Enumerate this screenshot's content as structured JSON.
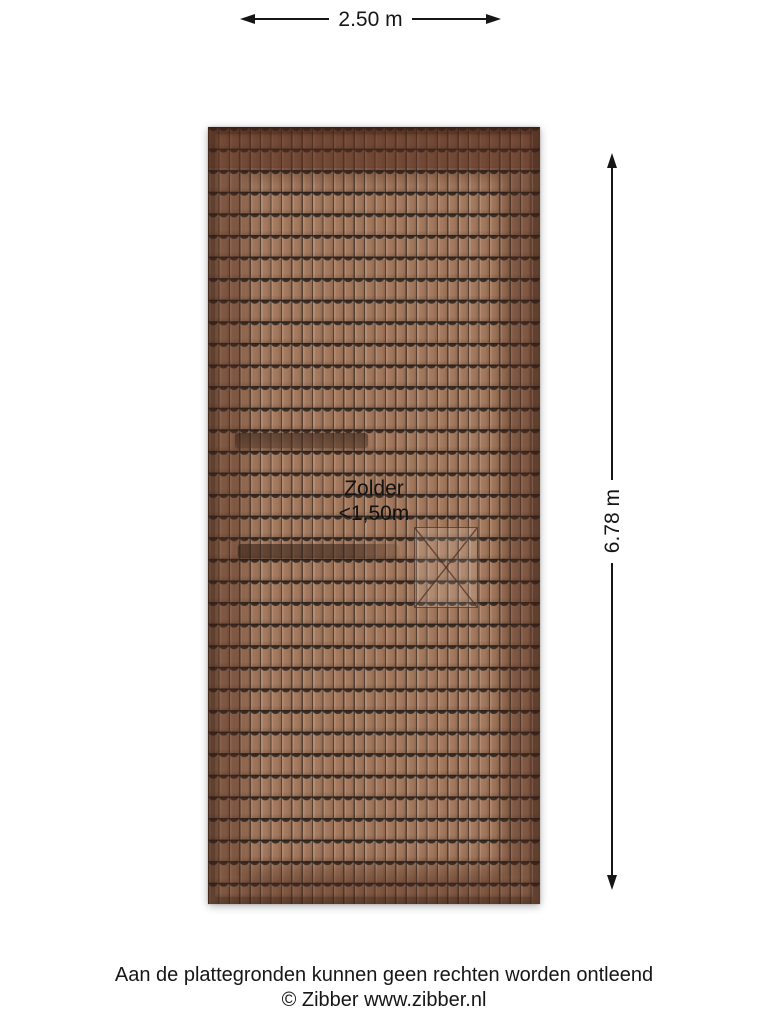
{
  "plan": {
    "room_label": "Zolder",
    "room_sublabel": "<1,50m",
    "width_label": "2.50 m",
    "height_label": "6.78 m",
    "features": {
      "skylight": "roof-window-marked-with-x",
      "beams": 2
    }
  },
  "footer": {
    "disclaimer": "Aan de plattegronden kunnen geen rechten worden ontleend",
    "copyright": "© Zibber www.zibber.nl"
  },
  "colors": {
    "tile_base": "#a87c60",
    "tile_dark_line": "#2e2724",
    "edge_shade": "#4a291c",
    "text_color": "#161616",
    "page_bg": "#ffffff"
  }
}
